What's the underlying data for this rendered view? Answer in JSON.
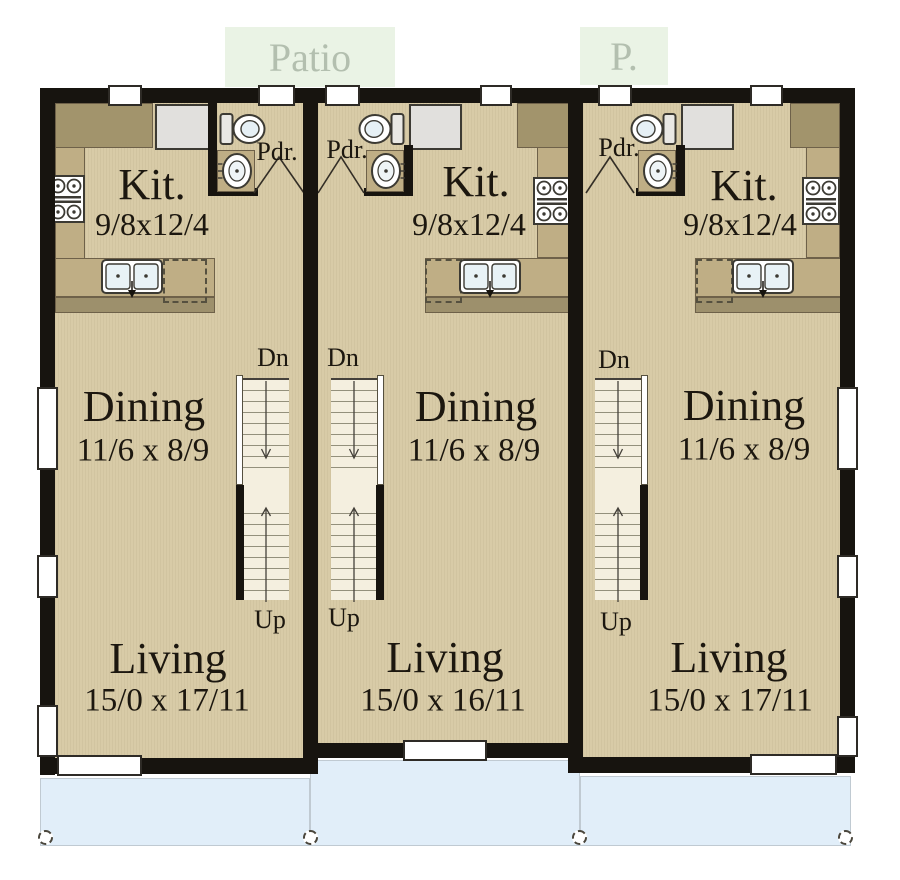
{
  "palette": {
    "wall": "#17140f",
    "floor": "#d8cba7",
    "counter": "#bfae85",
    "counterDark": "#a2946c",
    "stairBg": "#f4efdf",
    "patioBg": "#eaf3e5",
    "patioText": "#b3bfaf",
    "deck": "#e1eef9",
    "ink": "#1c170f"
  },
  "outdoor": {
    "patio_label": "Patio",
    "patio_label_short": "P."
  },
  "units": [
    {
      "kitchen_label": "Kit.",
      "kitchen_dims": "9/8x12/4",
      "powder_label": "Pdr.",
      "stair_down": "Dn",
      "stair_up": "Up",
      "dining_label": "Dining",
      "dining_dims": "11/6 x 8/9",
      "living_label": "Living",
      "living_dims": "15/0 x 17/11"
    },
    {
      "kitchen_label": "Kit.",
      "kitchen_dims": "9/8x12/4",
      "powder_label": "Pdr.",
      "stair_down": "Dn",
      "stair_up": "Up",
      "dining_label": "Dining",
      "dining_dims": "11/6 x 8/9",
      "living_label": "Living",
      "living_dims": "15/0 x 16/11"
    },
    {
      "kitchen_label": "Kit.",
      "kitchen_dims": "9/8x12/4",
      "powder_label": "Pdr.",
      "stair_down": "Dn",
      "stair_up": "Up",
      "dining_label": "Dining",
      "dining_dims": "11/6 x 8/9",
      "living_label": "Living",
      "living_dims": "15/0 x 17/11"
    }
  ]
}
